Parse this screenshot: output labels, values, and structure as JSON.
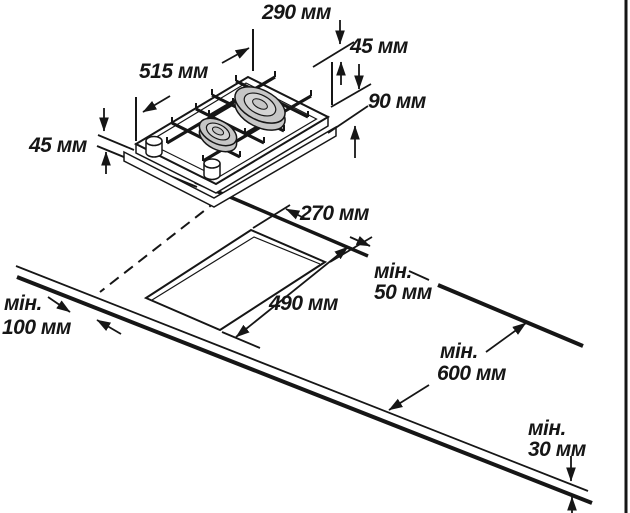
{
  "diagram": {
    "kind": "installation-dimensions-drawing",
    "subject": "two-burner domino gas hob with worktop cutout",
    "unit": "мм"
  },
  "labels": {
    "hob_width": "290 мм",
    "back_offset": "45 мм",
    "hob_depth": "515 мм",
    "burner_band": "90 мм",
    "side_height": "45 мм",
    "cutout_width": "270 мм",
    "min_back_line1": "мін.",
    "min_back_line2": "50 мм",
    "cutout_depth": "490 мм",
    "min_left_line1": "мін.",
    "min_left_line2": "100 мм",
    "min_worktop_line1": "мін.",
    "min_worktop_line2": "600 мм",
    "min_below_line1": "мін.",
    "min_below_line2": "30 мм"
  },
  "colors": {
    "line": "#161616",
    "burner_fill": "#c6c6c6",
    "burner_inner": "#d4d4d4",
    "background": "#ffffff"
  }
}
